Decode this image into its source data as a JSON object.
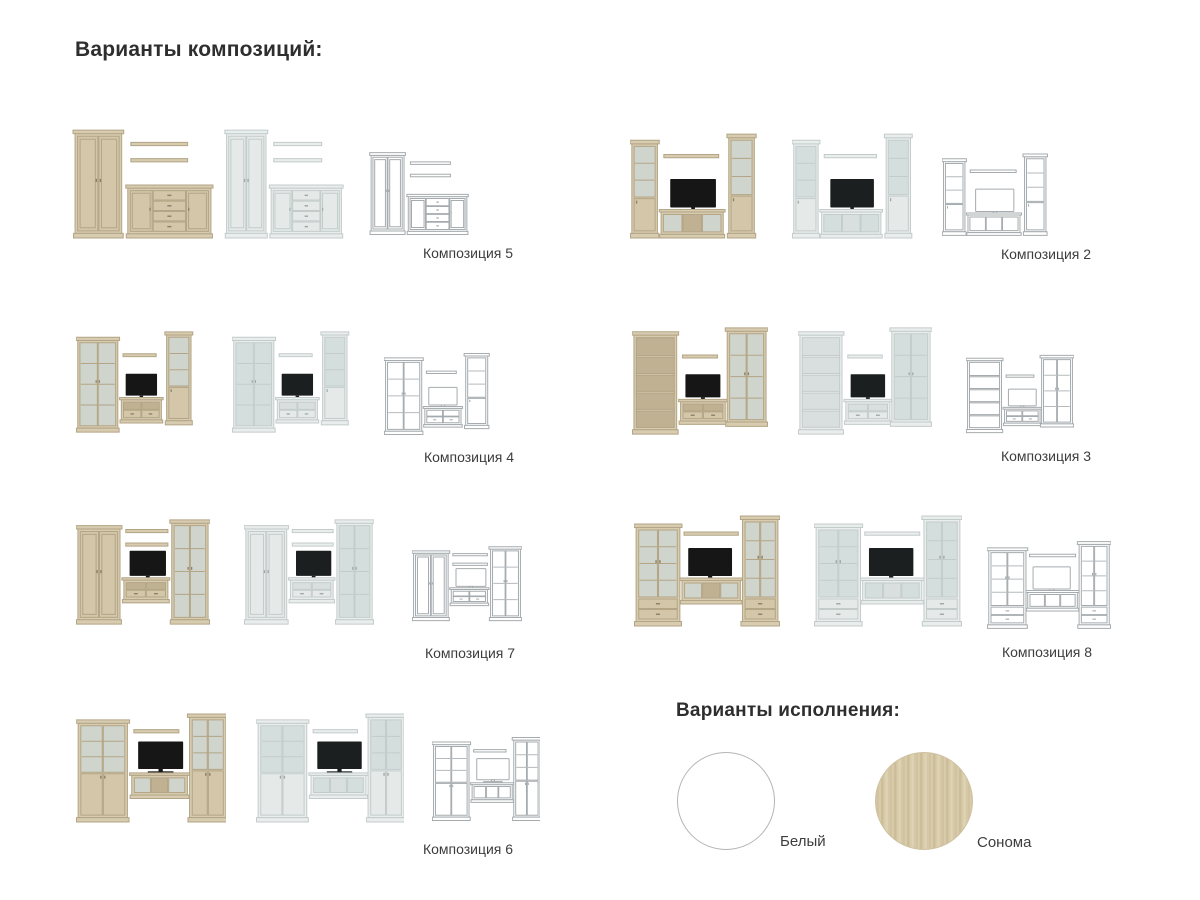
{
  "headings": {
    "compositions": "Варианты композиций:",
    "finishes": "Варианты исполнения:"
  },
  "finishes": [
    {
      "id": "white",
      "label": "Белый",
      "color": "#ffffff"
    },
    {
      "id": "sonoma",
      "label": "Сонома",
      "color": "#d3c5a2"
    }
  ],
  "ui": {
    "heading_color": "#2e2e2e",
    "caption_color": "#3d3d3d",
    "white_swatch_border": "#b5b5b5"
  },
  "palette": {
    "sonoma": {
      "body": "#d7cbb0",
      "door": "#d3c6a9",
      "edge": "#b3a585",
      "glass": "#cfd4cd",
      "open": "#bfb192",
      "shelfline": "#b3a585",
      "hdl": "#8c8065",
      "tv": "#161616",
      "tvEdge": ""
    },
    "white": {
      "body": "#e9edec",
      "door": "#e5eae9",
      "edge": "#c3cccb",
      "glass": "#d4dedd",
      "open": "#d9dfde",
      "shelfline": "#c3cccb",
      "hdl": "#9fa8a7",
      "tv": "#1b1f1f",
      "tvEdge": ""
    },
    "wire": {
      "body": "#ffffff",
      "door": "#ffffff",
      "edge": "#a5abae",
      "glass": "#ffffff",
      "open": "#ffffff",
      "shelfline": "#b4babd",
      "hdl": "#a5abae",
      "tv": "#ffffff",
      "tvEdge": "#a5abae"
    }
  },
  "compositions": [
    {
      "id": "5",
      "label": "Композиция 5",
      "pieces": [
        {
          "t": "wardrobe",
          "x": 3,
          "y": 6,
          "w": 46,
          "h": 106
        },
        {
          "t": "shelf",
          "x": 58,
          "y": 18,
          "w": 56
        },
        {
          "t": "shelf",
          "x": 58,
          "y": 34,
          "w": 56
        },
        {
          "t": "sideboard",
          "x": 55,
          "y": 60,
          "w": 82,
          "h": 52
        }
      ]
    },
    {
      "id": "2",
      "label": "Композиция 2",
      "pieces": [
        {
          "t": "glasscab",
          "x": 2,
          "y": 16,
          "w": 28,
          "h": 96
        },
        {
          "t": "shelf",
          "x": 37,
          "y": 30,
          "w": 60
        },
        {
          "t": "tv",
          "x": 44,
          "y": 54,
          "w": 50,
          "h": 28
        },
        {
          "t": "tvstand",
          "x": 34,
          "y": 84,
          "w": 68,
          "h": 28,
          "sec": 3,
          "glass": true
        },
        {
          "t": "glasscab",
          "x": 108,
          "y": 10,
          "w": 28,
          "h": 102
        }
      ]
    },
    {
      "id": "4",
      "label": "Композиция 4",
      "pieces": [
        {
          "t": "glasscab2",
          "x": 2,
          "y": 8,
          "w": 46,
          "h": 104
        },
        {
          "t": "shelf",
          "x": 54,
          "y": 26,
          "w": 38
        },
        {
          "t": "tv",
          "x": 57,
          "y": 48,
          "w": 36,
          "h": 24
        },
        {
          "t": "tvstand",
          "x": 52,
          "y": 74,
          "w": 46,
          "h": 28,
          "sec": 2,
          "drawers": true
        },
        {
          "t": "glasscab",
          "x": 104,
          "y": 2,
          "w": 28,
          "h": 102
        }
      ]
    },
    {
      "id": "3",
      "label": "Композиция 3",
      "pieces": [
        {
          "t": "bookshelf",
          "x": 2,
          "y": 6,
          "w": 44,
          "h": 106,
          "shelves": 4
        },
        {
          "t": "shelf",
          "x": 52,
          "y": 30,
          "w": 36
        },
        {
          "t": "tv",
          "x": 55,
          "y": 50,
          "w": 36,
          "h": 24
        },
        {
          "t": "tvstand",
          "x": 50,
          "y": 76,
          "w": 46,
          "h": 26,
          "sec": 2,
          "drawers": true
        },
        {
          "t": "glasscab2",
          "x": 98,
          "y": 2,
          "w": 40,
          "h": 102
        }
      ]
    },
    {
      "id": "7",
      "label": "Композиция 7",
      "pieces": [
        {
          "t": "wardrobe",
          "x": 2,
          "y": 10,
          "w": 44,
          "h": 102
        },
        {
          "t": "shelf",
          "x": 52,
          "y": 14,
          "w": 44
        },
        {
          "t": "shelf",
          "x": 52,
          "y": 28,
          "w": 44
        },
        {
          "t": "tv",
          "x": 56,
          "y": 36,
          "w": 38,
          "h": 26
        },
        {
          "t": "tvstand",
          "x": 50,
          "y": 64,
          "w": 46,
          "h": 26,
          "sec": 2,
          "drawers": true
        },
        {
          "t": "glasscab2",
          "x": 100,
          "y": 4,
          "w": 38,
          "h": 108
        }
      ]
    },
    {
      "id": "8",
      "label": "Композиция 8",
      "pieces": [
        {
          "t": "glasscab2",
          "x": 2,
          "y": 10,
          "w": 42,
          "h": 102,
          "drawers": 2
        },
        {
          "t": "shelf",
          "x": 48,
          "y": 18,
          "w": 52
        },
        {
          "t": "tv",
          "x": 52,
          "y": 34,
          "w": 42,
          "h": 28
        },
        {
          "t": "tvstand",
          "x": 46,
          "y": 64,
          "w": 56,
          "h": 26,
          "sec": 3,
          "glass": true
        },
        {
          "t": "glasscab2",
          "x": 104,
          "y": 2,
          "w": 34,
          "h": 110,
          "drawers": 2
        }
      ]
    },
    {
      "id": "6",
      "label": "Композиция 6",
      "pieces": [
        {
          "t": "cabhalf",
          "x": 2,
          "y": 8,
          "w": 46,
          "h": 104
        },
        {
          "t": "shelf",
          "x": 54,
          "y": 18,
          "w": 42
        },
        {
          "t": "tv",
          "x": 58,
          "y": 30,
          "w": 42,
          "h": 28
        },
        {
          "t": "tvstand",
          "x": 52,
          "y": 62,
          "w": 52,
          "h": 26,
          "sec": 3,
          "glass": true
        },
        {
          "t": "cabhalf",
          "x": 106,
          "y": 2,
          "w": 34,
          "h": 110
        }
      ]
    }
  ]
}
